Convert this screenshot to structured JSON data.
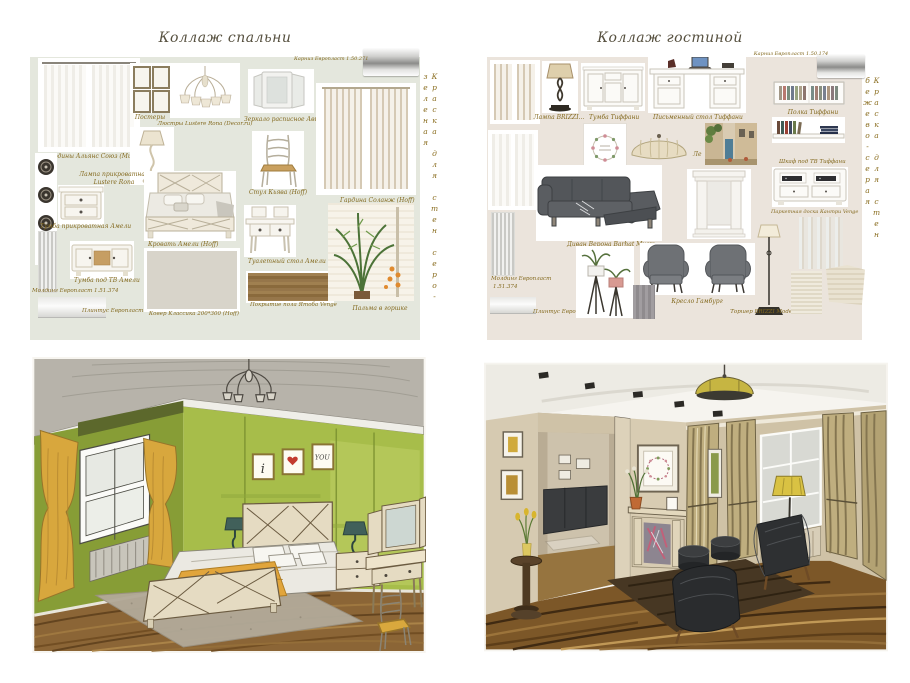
{
  "page": {
    "background": "#ffffff"
  },
  "bedroom_collage": {
    "title": "Коллаж спальни",
    "panel_color": "#e4e7dd",
    "label_color": "#83691e",
    "paint_label": "Краска для стен серо-зеленая",
    "labels": {
      "curtains": "Гардины Альянс Союз (Мир)",
      "posters": "Постеры",
      "chandelier": "Люстры Lustere Rona (Decor.ru)",
      "lamp_line1": "Лампа прикроватная",
      "lamp_line2": "Lustere Rona",
      "mirror": "Зеркало расписное Авила",
      "chair": "Стул Кьява (Hoff)",
      "nightstand": "Тумба прикроватная Амели",
      "bed": "Кровать Амели (Hoff)",
      "dressing_table": "Туалетный стол Амели",
      "molding": "Молдинг Европласт 1.51.374",
      "tv_stand": "Тумба под ТВ Амели",
      "plinth": "Плинтус Европласт 1.53.108",
      "carpet": "Ковер Классика 200*300 (Hoff)",
      "floor": "Покрытие пола Ятоба Venge",
      "cornice": "Карниз Европласт 1.50.271",
      "curtain2": "Гардина Соланж (Hoff)",
      "palm": "Пальма в горшке"
    }
  },
  "living_collage": {
    "title": "Коллаж гостиной",
    "panel_color": "#ebe4dc",
    "paint_label": "Краска для стен бежево-серая",
    "labels": {
      "lamp": "Лампа BRIZZI...",
      "cabinet": "Тумба Тиффани",
      "desk": "Письменный стол Тиффани",
      "note": "Ле",
      "sofa": "Диван Верона Barhat Мист",
      "molding_line1": "Молдинг Европласт",
      "molding_line2": "1.51.374",
      "plinth": "Плинтус Европласт 1.53.108",
      "armchair": "Кресло Гамбург",
      "floor_lamp": "Торшер BRIZZI Modern BL",
      "cornice": "Карниз Европласт 1.50.174",
      "shelf": "Полка Тиффани",
      "tv_cabinet": "Шкаф под ТВ Тиффани",
      "parquet": "Паркетная доска Кантри Venge"
    }
  },
  "sketches": {
    "bedroom": {
      "art_left": "i",
      "art_right": "YOU"
    }
  }
}
